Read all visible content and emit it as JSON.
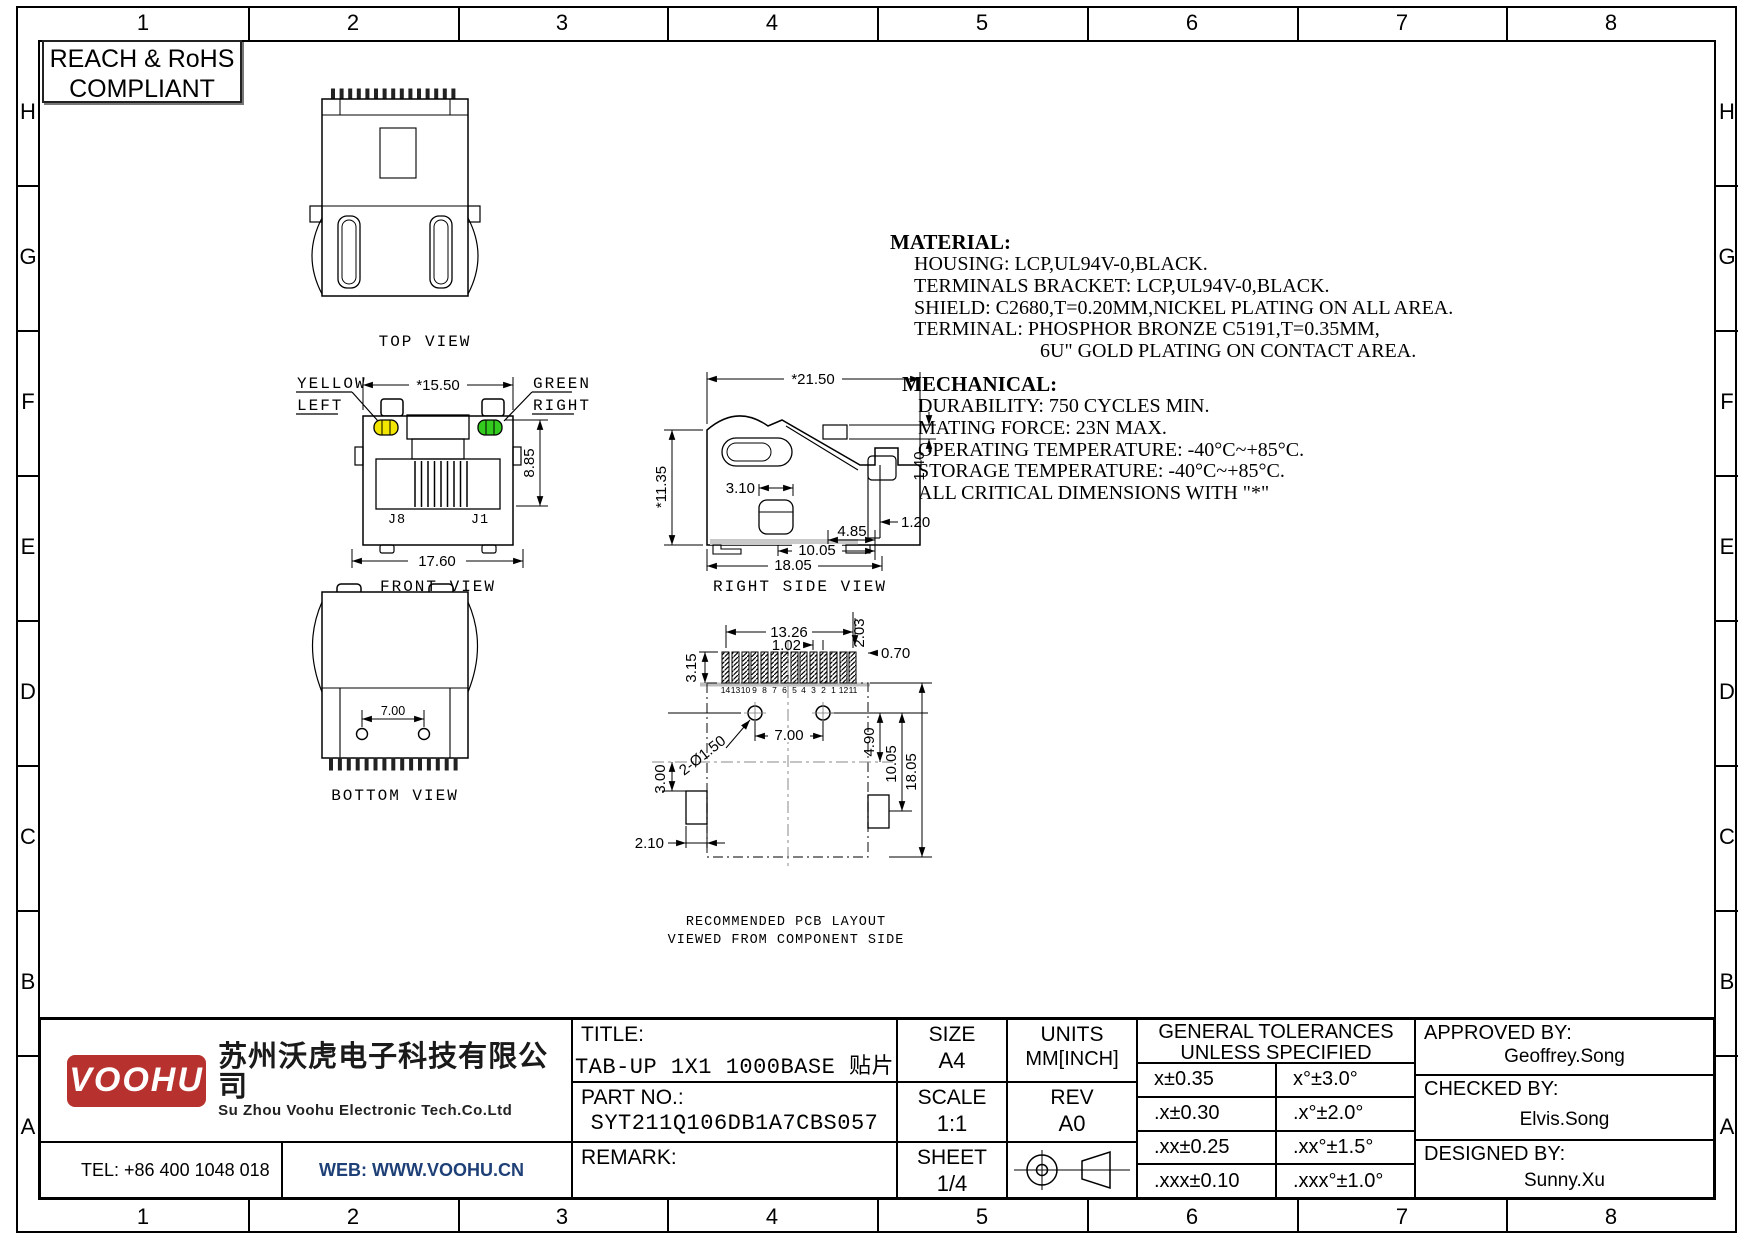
{
  "frame": {
    "cols": [
      "1",
      "2",
      "3",
      "4",
      "5",
      "6",
      "7",
      "8"
    ],
    "rows": [
      "H",
      "G",
      "F",
      "E",
      "D",
      "C",
      "B",
      "A"
    ]
  },
  "compliance": {
    "line1": "REACH & RoHS",
    "line2": "COMPLIANT"
  },
  "views": {
    "top": {
      "label": "TOP VIEW"
    },
    "front": {
      "label": "FRONT VIEW",
      "dim_width": "*15.50",
      "dim_height": "8.85",
      "dim_outer": "17.60",
      "led_left_1": "YELLOW",
      "led_left_2": "LEFT",
      "led_right_1": "GREEN",
      "led_right_2": "RIGHT",
      "pin_left": "J8",
      "pin_right": "J1"
    },
    "side": {
      "label": "RIGHT SIDE VIEW",
      "dim_length": "*21.50",
      "dim_height": "*11.35",
      "dim_post": "3.10",
      "dim_tab": "1.40",
      "dim_foot": "1.20",
      "dim_a": "4.85",
      "dim_b": "10.05",
      "dim_c": "18.05"
    },
    "bottom": {
      "label": "BOTTOM VIEW",
      "dim_posts": "7.00"
    },
    "pcb": {
      "label1": "RECOMMENDED PCB LAYOUT",
      "label2": "VIEWED FROM COMPONENT SIDE",
      "dim_row": "13.26",
      "dim_pitch": "1.02",
      "dim_pad2": "2.03",
      "dim_pad3": "0.70",
      "dim_pad_h": "3.15",
      "dim_holes": "7.00",
      "dim_hole_d": "2-Ø1.50",
      "dim_e": "4.90",
      "dim_f": "10.05",
      "dim_g": "18.05",
      "dim_tab_h": "3.00",
      "dim_tab_w": "2.10",
      "pins": [
        "14",
        "13",
        "10",
        "9",
        "8",
        "7",
        "6",
        "5",
        "4",
        "3",
        "2",
        "1",
        "12",
        "11"
      ]
    }
  },
  "notes": {
    "material_title": "MATERIAL:",
    "material": [
      "HOUSING: LCP,UL94V-0,BLACK.",
      "TERMINALS BRACKET: LCP,UL94V-0,BLACK.",
      "SHIELD: C2680,T=0.20MM,NICKEL PLATING ON ALL AREA.",
      "TERMINAL: PHOSPHOR BRONZE C5191,T=0.35MM,",
      "6U\" GOLD PLATING ON CONTACT AREA."
    ],
    "mechanical_title": "MECHANICAL:",
    "mechanical": [
      "DURABILITY: 750 CYCLES MIN.",
      "MATING FORCE: 23N MAX.",
      "OPERATING TEMPERATURE: -40°C~+85°C.",
      "STORAGE TEMPERATURE: -40°C~+85°C.",
      "ALL CRITICAL DIMENSIONS WITH \"*\""
    ]
  },
  "title_block": {
    "title_label": "TITLE:",
    "title_value": "TAB-UP 1X1 1000BASE 贴片",
    "part_label": "PART NO.:",
    "part_value": "SYT211Q106DB1A7CBS057",
    "remark_label": "REMARK:",
    "size_label": "SIZE",
    "size_value": "A4",
    "scale_label": "SCALE",
    "scale_value": "1:1",
    "sheet_label": "SHEET",
    "sheet_value": "1/4",
    "units_label": "UNITS",
    "units_value": "MM[INCH]",
    "rev_label": "REV",
    "rev_value": "A0",
    "tol_header1": "GENERAL TOLERANCES",
    "tol_header2": "UNLESS SPECIFIED",
    "tolerances": [
      [
        "x±0.35",
        "x°±3.0°"
      ],
      [
        ".x±0.30",
        ".x°±2.0°"
      ],
      [
        ".xx±0.25",
        ".xx°±1.5°"
      ],
      [
        ".xxx±0.10",
        ".xxx°±1.0°"
      ]
    ],
    "approved_label": "APPROVED BY:",
    "approved_value": "Geoffrey.Song",
    "checked_label": "CHECKED BY:",
    "checked_value": "Elvis.Song",
    "designed_label": "DESIGNED BY:",
    "designed_value": "Sunny.Xu"
  },
  "company": {
    "logo": "VOOHU",
    "name_cn": "苏州沃虎电子科技有限公司",
    "name_en": "Su Zhou Voohu Electronic Tech.Co.Ltd",
    "tel": "TEL: +86 400 1048 018",
    "web": "WEB: WWW.VOOHU.CN"
  },
  "colors": {
    "led_yellow": "#f2e600",
    "led_green": "#33cc1e",
    "logo_red": "#b7322e",
    "web_blue": "#1e4077"
  }
}
